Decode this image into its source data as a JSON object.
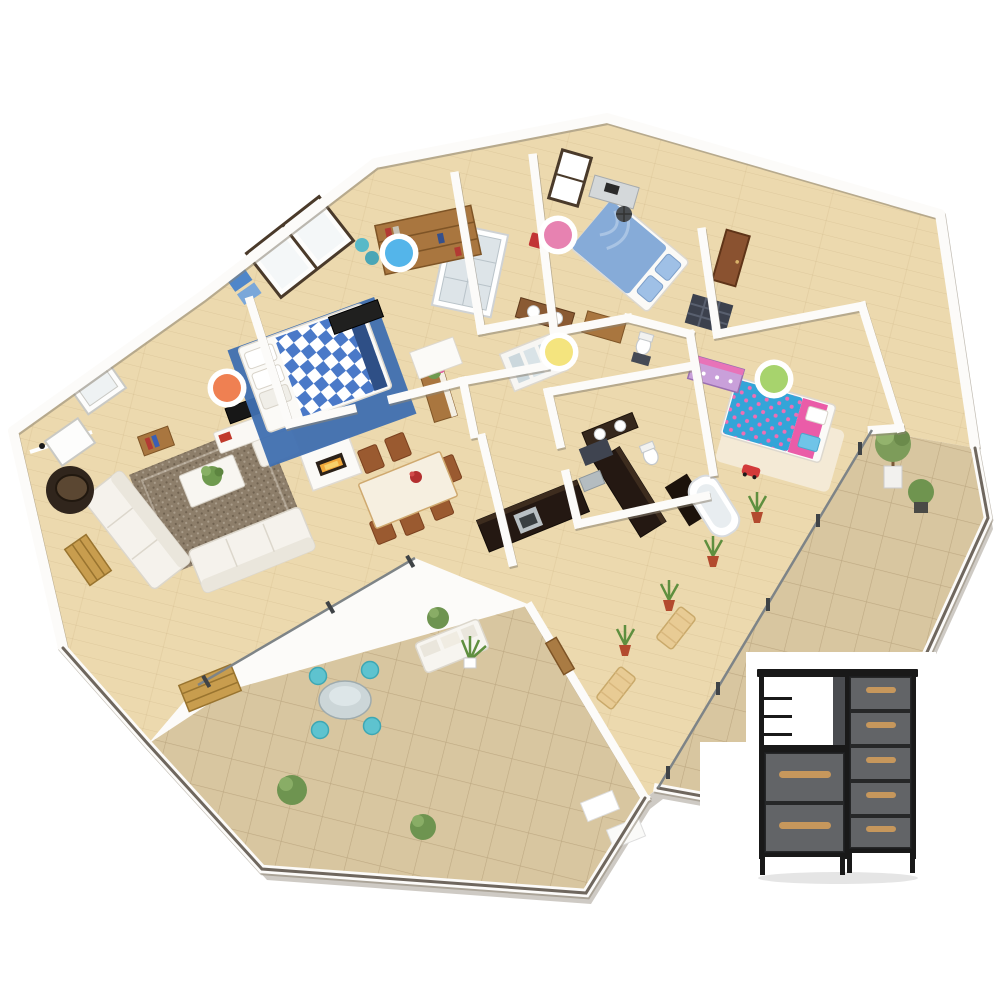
{
  "window": {
    "width": 1000,
    "height": 1000,
    "background": "#ffffff"
  },
  "scene": {
    "description": "3D isometric rendering of an apartment floor plan with five colored candidate-location markers and a product photo of a fabric dresser in the lower-right corner",
    "rooms": [
      "living-room",
      "dining-area",
      "kitchen",
      "master-bedroom",
      "second-bedroom",
      "kids-bedroom",
      "bathroom",
      "wc",
      "entry-hall",
      "hallway",
      "terrace-left",
      "terrace-right"
    ]
  },
  "palette": {
    "floor_wood": "#ecd9ae",
    "terrace_tile": "#d8c6a0",
    "wall_white": "#fcfbf9",
    "base_shadow": "#9d968a",
    "railing_cap": "#6f675e",
    "glass_line": "#7e8487",
    "rug_living": "#8d7e6a",
    "bed_blue": "#4a79c8",
    "kids_blue": "#33a5d8",
    "kids_pink": "#ea5ca8",
    "wood_furniture": "#a9763f"
  },
  "markers": [
    {
      "name": "marker-blue",
      "color_name": "blue",
      "hex": "#54b5ea",
      "ring": "#ffffff",
      "cx": 399,
      "cy": 253,
      "r": 14,
      "ring_r": 19.5
    },
    {
      "name": "marker-pink",
      "color_name": "pink",
      "hex": "#e782b1",
      "ring": "#ffffff",
      "cx": 558,
      "cy": 235,
      "r": 14,
      "ring_r": 19.5
    },
    {
      "name": "marker-yellow",
      "color_name": "yellow",
      "hex": "#f4e47e",
      "ring": "#ffffff",
      "cx": 559,
      "cy": 352,
      "r": 14,
      "ring_r": 19.5
    },
    {
      "name": "marker-orange",
      "color_name": "orange",
      "hex": "#ef8052",
      "ring": "#ffffff",
      "cx": 227,
      "cy": 388,
      "r": 14,
      "ring_r": 19.5
    },
    {
      "name": "marker-green",
      "color_name": "green",
      "hex": "#a7d36d",
      "ring": "#ffffff",
      "cx": 774,
      "cy": 379,
      "r": 14,
      "ring_r": 19.5
    }
  ],
  "product": {
    "name": "fabric-dresser-7-drawer",
    "frame": "#191919",
    "fabric": "#5b5d61",
    "side_panel": "#4a4c50",
    "handle": "#c6975c",
    "left_drawer_count": 2,
    "right_drawer_count": 5
  }
}
